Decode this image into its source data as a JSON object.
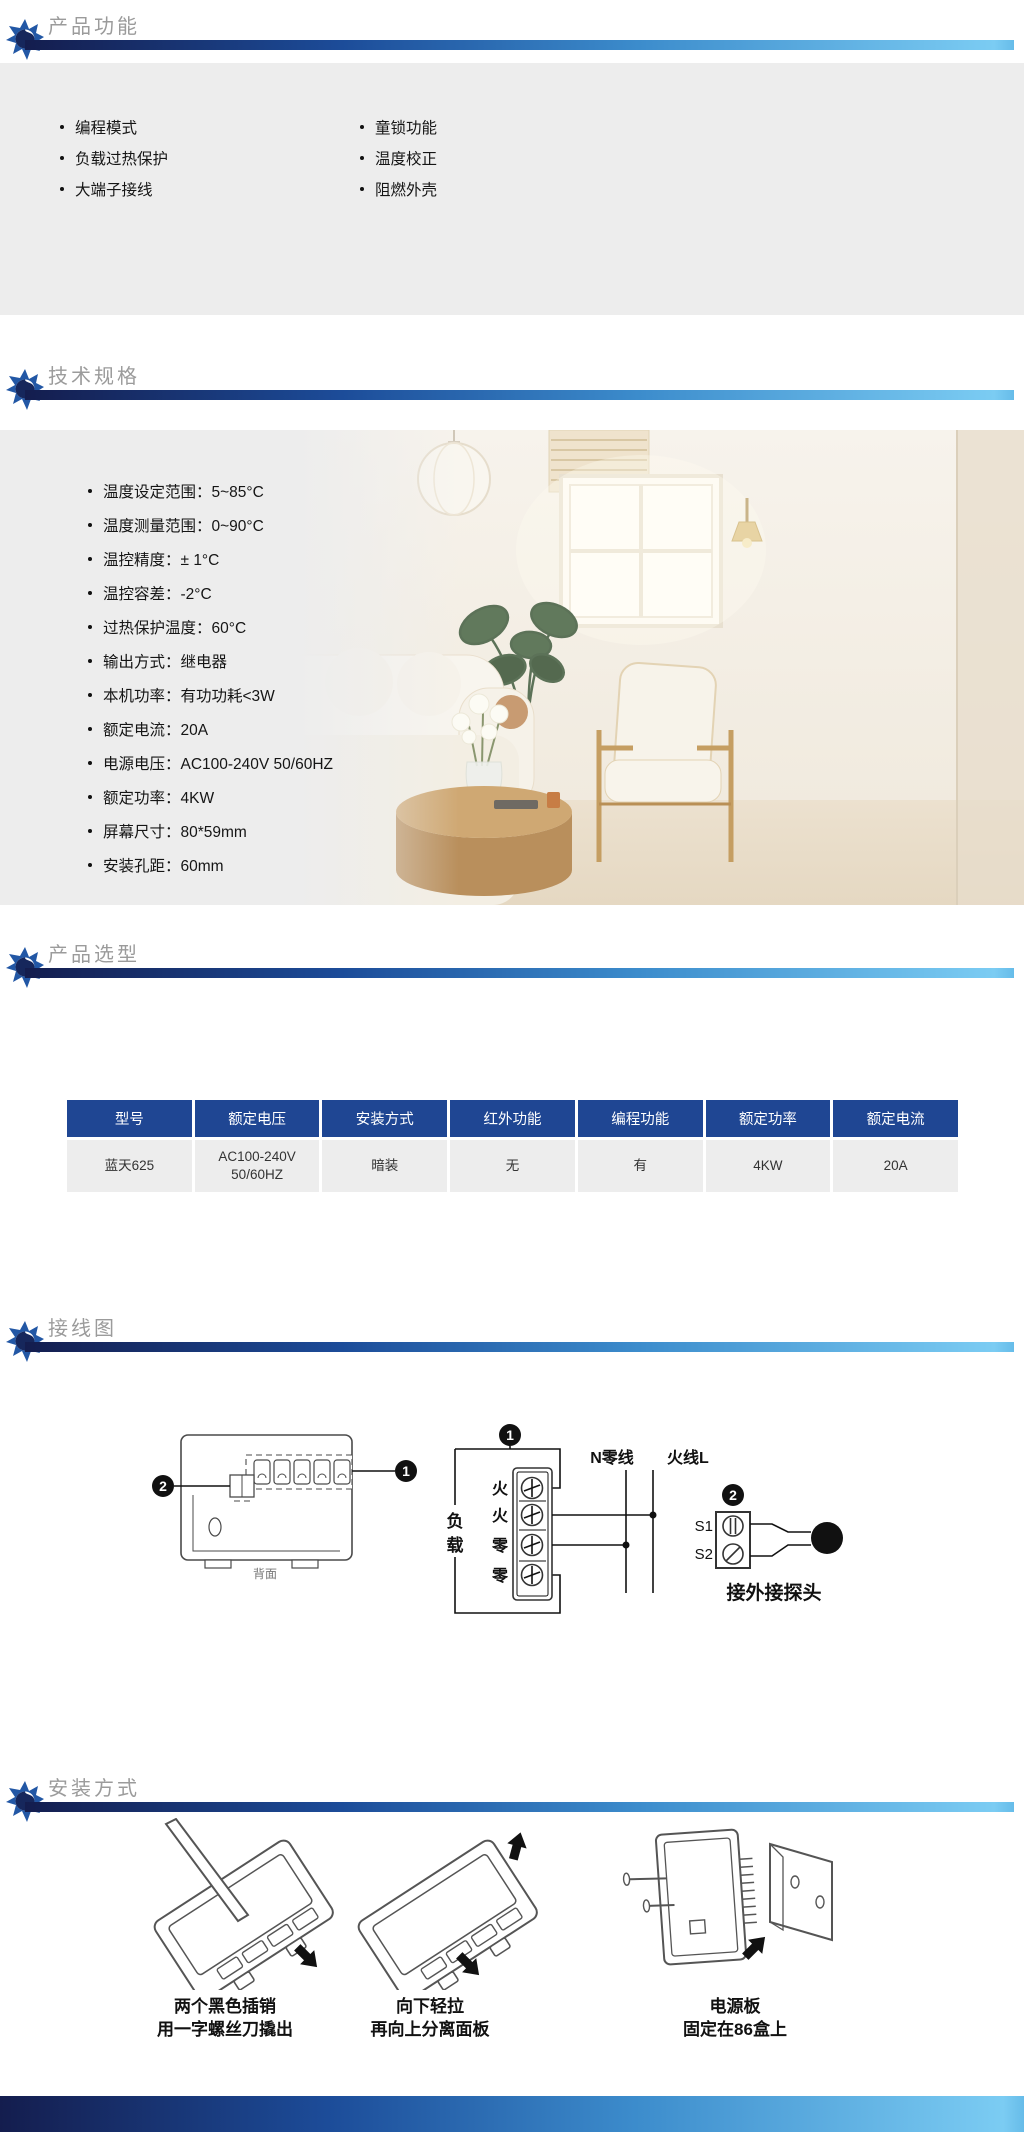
{
  "sections": {
    "features": {
      "title": "产品功能",
      "columns": [
        [
          "编程模式",
          "负载过热保护",
          "大端子接线"
        ],
        [
          "童锁功能",
          "温度校正",
          "阻燃外壳"
        ]
      ]
    },
    "specs": {
      "title": "技术规格",
      "items": [
        "温度设定范围：5~85°C",
        "温度测量范围：0~90°C",
        "温控精度：± 1°C",
        "温控容差：-2°C",
        "过热保护温度：60°C",
        "输出方式：继电器",
        "本机功率：有功功耗<3W",
        "额定电流：20A",
        "电源电压：AC100-240V 50/60HZ",
        "额定功率：4KW",
        "屏幕尺寸：80*59mm",
        "安装孔距：60mm"
      ]
    },
    "selection": {
      "title": "产品选型",
      "headers": [
        "型号",
        "额定电压",
        "安装方式",
        "红外功能",
        "编程功能",
        "额定功率",
        "额定电流"
      ],
      "row": [
        "蓝天625",
        "AC100-240V\n50/60HZ",
        "暗装",
        "无",
        "有",
        "4KW",
        "20A"
      ]
    },
    "wiring": {
      "title": "接线图",
      "badge1": "1",
      "badge2": "2",
      "back_caption": "背面",
      "load_char_1": "负",
      "load_char_2": "载",
      "terminals": [
        "火",
        "火",
        "零",
        "零"
      ],
      "neutral_label": "N零线",
      "live_label": "火线L",
      "s1": "S1",
      "s2": "S2",
      "probe_caption": "接外接探头"
    },
    "install": {
      "title": "安装方式",
      "steps": [
        {
          "line1": "两个黑色插销",
          "line2": "用一字螺丝刀撬出"
        },
        {
          "line1": "向下轻拉",
          "line2": "再向上分离面板"
        },
        {
          "line1": "电源板",
          "line2": "固定在86盒上"
        }
      ]
    }
  },
  "colors": {
    "bar_start": "#141d4e",
    "bar_end": "#7bccf3",
    "table_header_bg": "#1f4693",
    "block_bg": "#ededed",
    "title_gray": "#9b9b9b"
  }
}
